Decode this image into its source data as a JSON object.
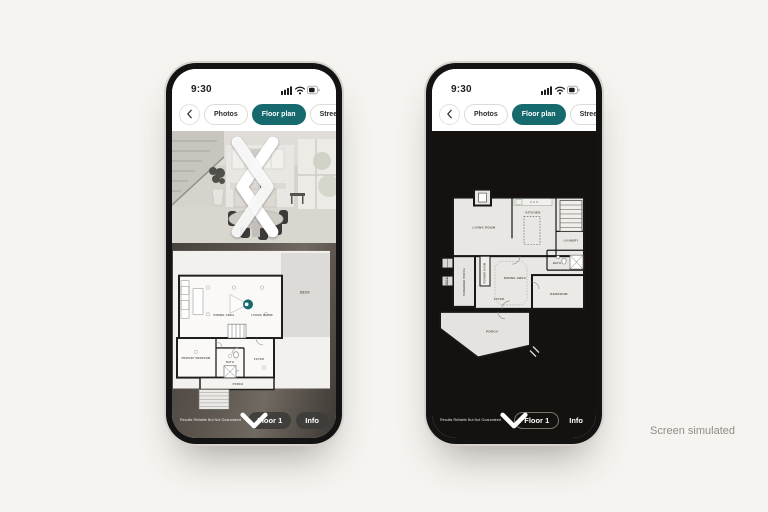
{
  "caption": "Screen simulated",
  "phone": {
    "status_time": "9:30",
    "nav": {
      "tabs": [
        {
          "label": "Photos"
        },
        {
          "label": "Floor plan"
        },
        {
          "label": "Street view"
        }
      ],
      "active_tab": "Floor plan"
    },
    "footer": {
      "disclaimer": "Results Reliable But Not Guaranteed",
      "floor_label": "Floor 1",
      "info_label": "Info"
    }
  },
  "left_phone": {
    "plan_labels": {
      "deck": "DECK",
      "dining": "DINING AREA",
      "living": "LIVING ROOM",
      "primary_bedroom": "PRIMARY BEDROOM",
      "bath": "BATH",
      "foyer": "FOYER",
      "porch": "PORCH"
    }
  },
  "right_phone": {
    "plan_labels": {
      "living": "LIVING ROOM",
      "kitchen": "KITCHEN",
      "laundry": "LAUNDRY",
      "bath": "BATH",
      "dining": "DINING AREA",
      "bedroom": "BEDROOM",
      "screened_porch": "SCREENED PORCH",
      "powder_room": "POWDER ROOM",
      "foyer": "FOYER",
      "porch": "PORCH",
      "deck": "DECK"
    }
  },
  "colors": {
    "accent_teal": "#166a6e",
    "canvas_bg": "#f5f4f0",
    "dark_screen_bg": "#14110f"
  }
}
